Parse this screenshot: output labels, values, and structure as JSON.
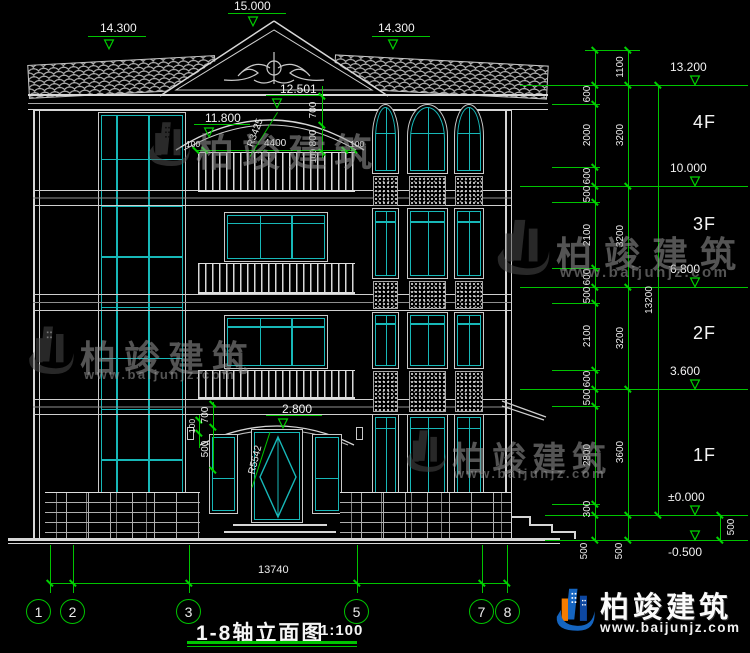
{
  "watermark": {
    "brand": "柏竣建筑",
    "site": "www.baijunjz.com"
  },
  "footer_logo": {
    "brand": "柏竣建筑",
    "site": "www.baijunjz.com"
  },
  "title_block": {
    "title": "1-8轴立面图",
    "scale": "1:100"
  },
  "icons": {
    "level_triangle": "▽"
  },
  "top_markers": [
    "14.300",
    "15.000",
    "14.300"
  ],
  "levels": {
    "v13200": "13.200",
    "v10000": "10.000",
    "v6800": "6.800",
    "v3600": "3.600",
    "v0": "±0.000",
    "vm500": "-0.500"
  },
  "floors": [
    "4F",
    "3F",
    "2F",
    "1F"
  ],
  "facade": {
    "m12501": "12.501",
    "m11800": "11.800",
    "m2800": "2.800",
    "d700": "700",
    "d800": "800",
    "d100a": "100",
    "d100l": "100",
    "d4400": "4400",
    "d100r": "100",
    "r_arc": "R3425",
    "r_door": "R5542",
    "e100": "100",
    "e700": "700",
    "e500": "500"
  },
  "chains": {
    "small": [
      "600",
      "2000",
      "600",
      "500",
      "2100",
      "600",
      "500",
      "2100",
      "600",
      "500",
      "2800",
      "300"
    ],
    "floor_heights": [
      "1100",
      "3200",
      "3200",
      "3200",
      "3600"
    ],
    "overall_v": "13200",
    "b500l": "500",
    "b500m": "500",
    "b500r": "500"
  },
  "bottom": {
    "overall": "13740",
    "axes": [
      "1",
      "2",
      "3",
      "5",
      "7",
      "8"
    ]
  }
}
